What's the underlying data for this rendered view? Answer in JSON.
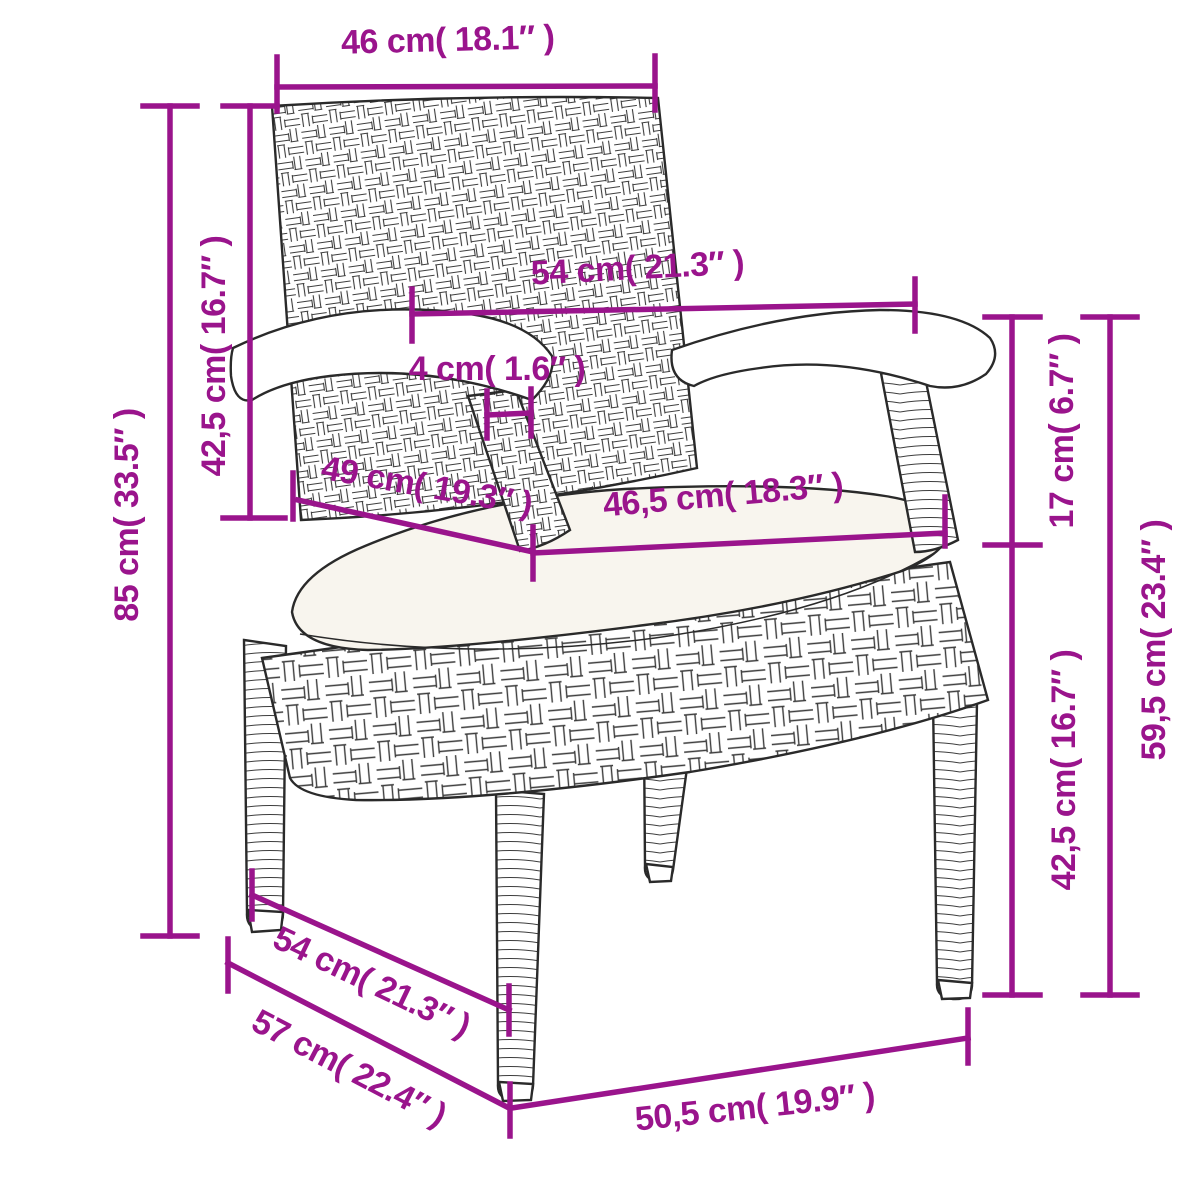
{
  "figure": {
    "kind": "product-dimension-diagram",
    "illustration": "rattan-garden-chair-with-cushion-line-art",
    "accent_color": "#9a148c",
    "line_art_color": "#2a2a2a",
    "cushion_color": "#f8f5ee",
    "background_color": "#ffffff"
  },
  "dimensions": {
    "back_top_width": "46 cm( 18.1″ )",
    "overall_height": "85 cm( 33.5″ )",
    "back_height": "42,5 cm( 16.7″ )",
    "arm_span": "54 cm( 21.3″ )",
    "armrest_thickness": "4 cm( 1.6″ )",
    "seat_depth": "49 cm( 19.3″ )",
    "cushion_width": "46,5 cm( 18.3″ )",
    "seat_to_arm": "17 cm( 6.7″ )",
    "arm_height_ground": "59,5 cm( 23.4″ )",
    "seat_height": "42,5 cm( 16.7″ )",
    "base_depth_upper": "54 cm( 21.3″ )",
    "base_depth_lower": "57 cm( 22.4″ )",
    "base_width": "50,5 cm( 19.9″ )"
  }
}
